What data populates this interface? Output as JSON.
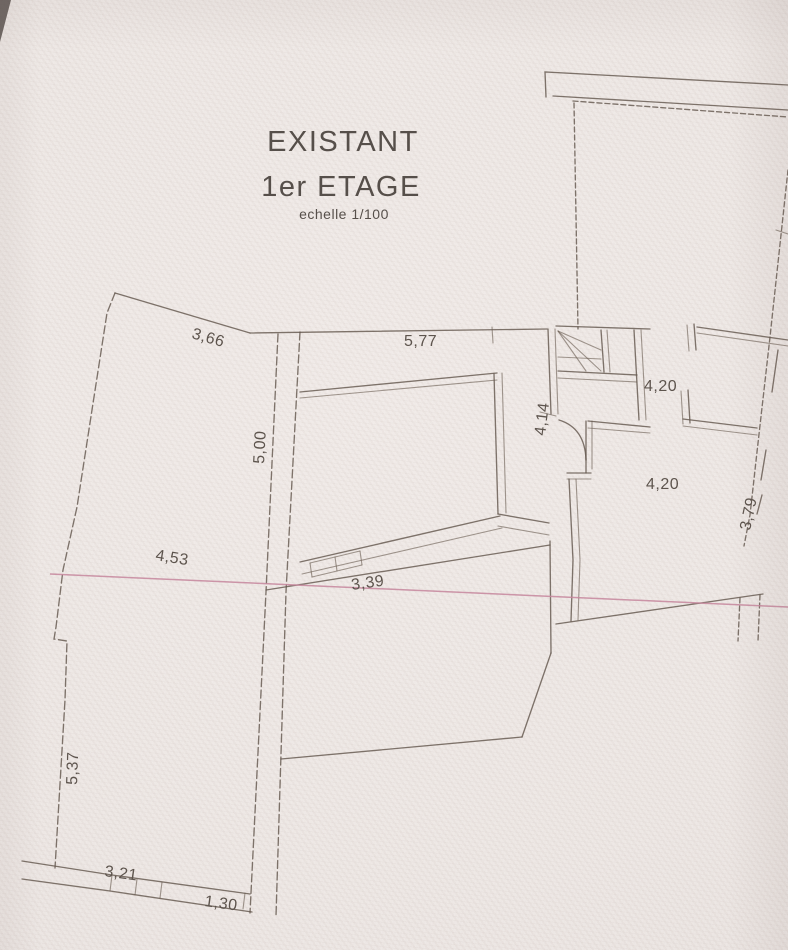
{
  "title": {
    "name": "EXISTANT",
    "floor": "1er ETAGE",
    "scale": "echelle 1/100"
  },
  "dimensions": {
    "top_left_diagonal": "3,66",
    "top_width": "5,77",
    "upper_right_room": "4,20",
    "stair_hall_height": "4,14",
    "right_room": "4,20",
    "left_interior_wall": "5,00",
    "mid_left": "4,53",
    "corridor": "3,39",
    "right_boundary": "3,79",
    "lower_left_wall": "5,37",
    "bottom_wall": "3,21",
    "bottom_opening": "1,30"
  },
  "colors": {
    "ink": "#64584e",
    "pink_line": "#c5869c",
    "paper": "#ece6e3",
    "text": "#564f4a"
  }
}
